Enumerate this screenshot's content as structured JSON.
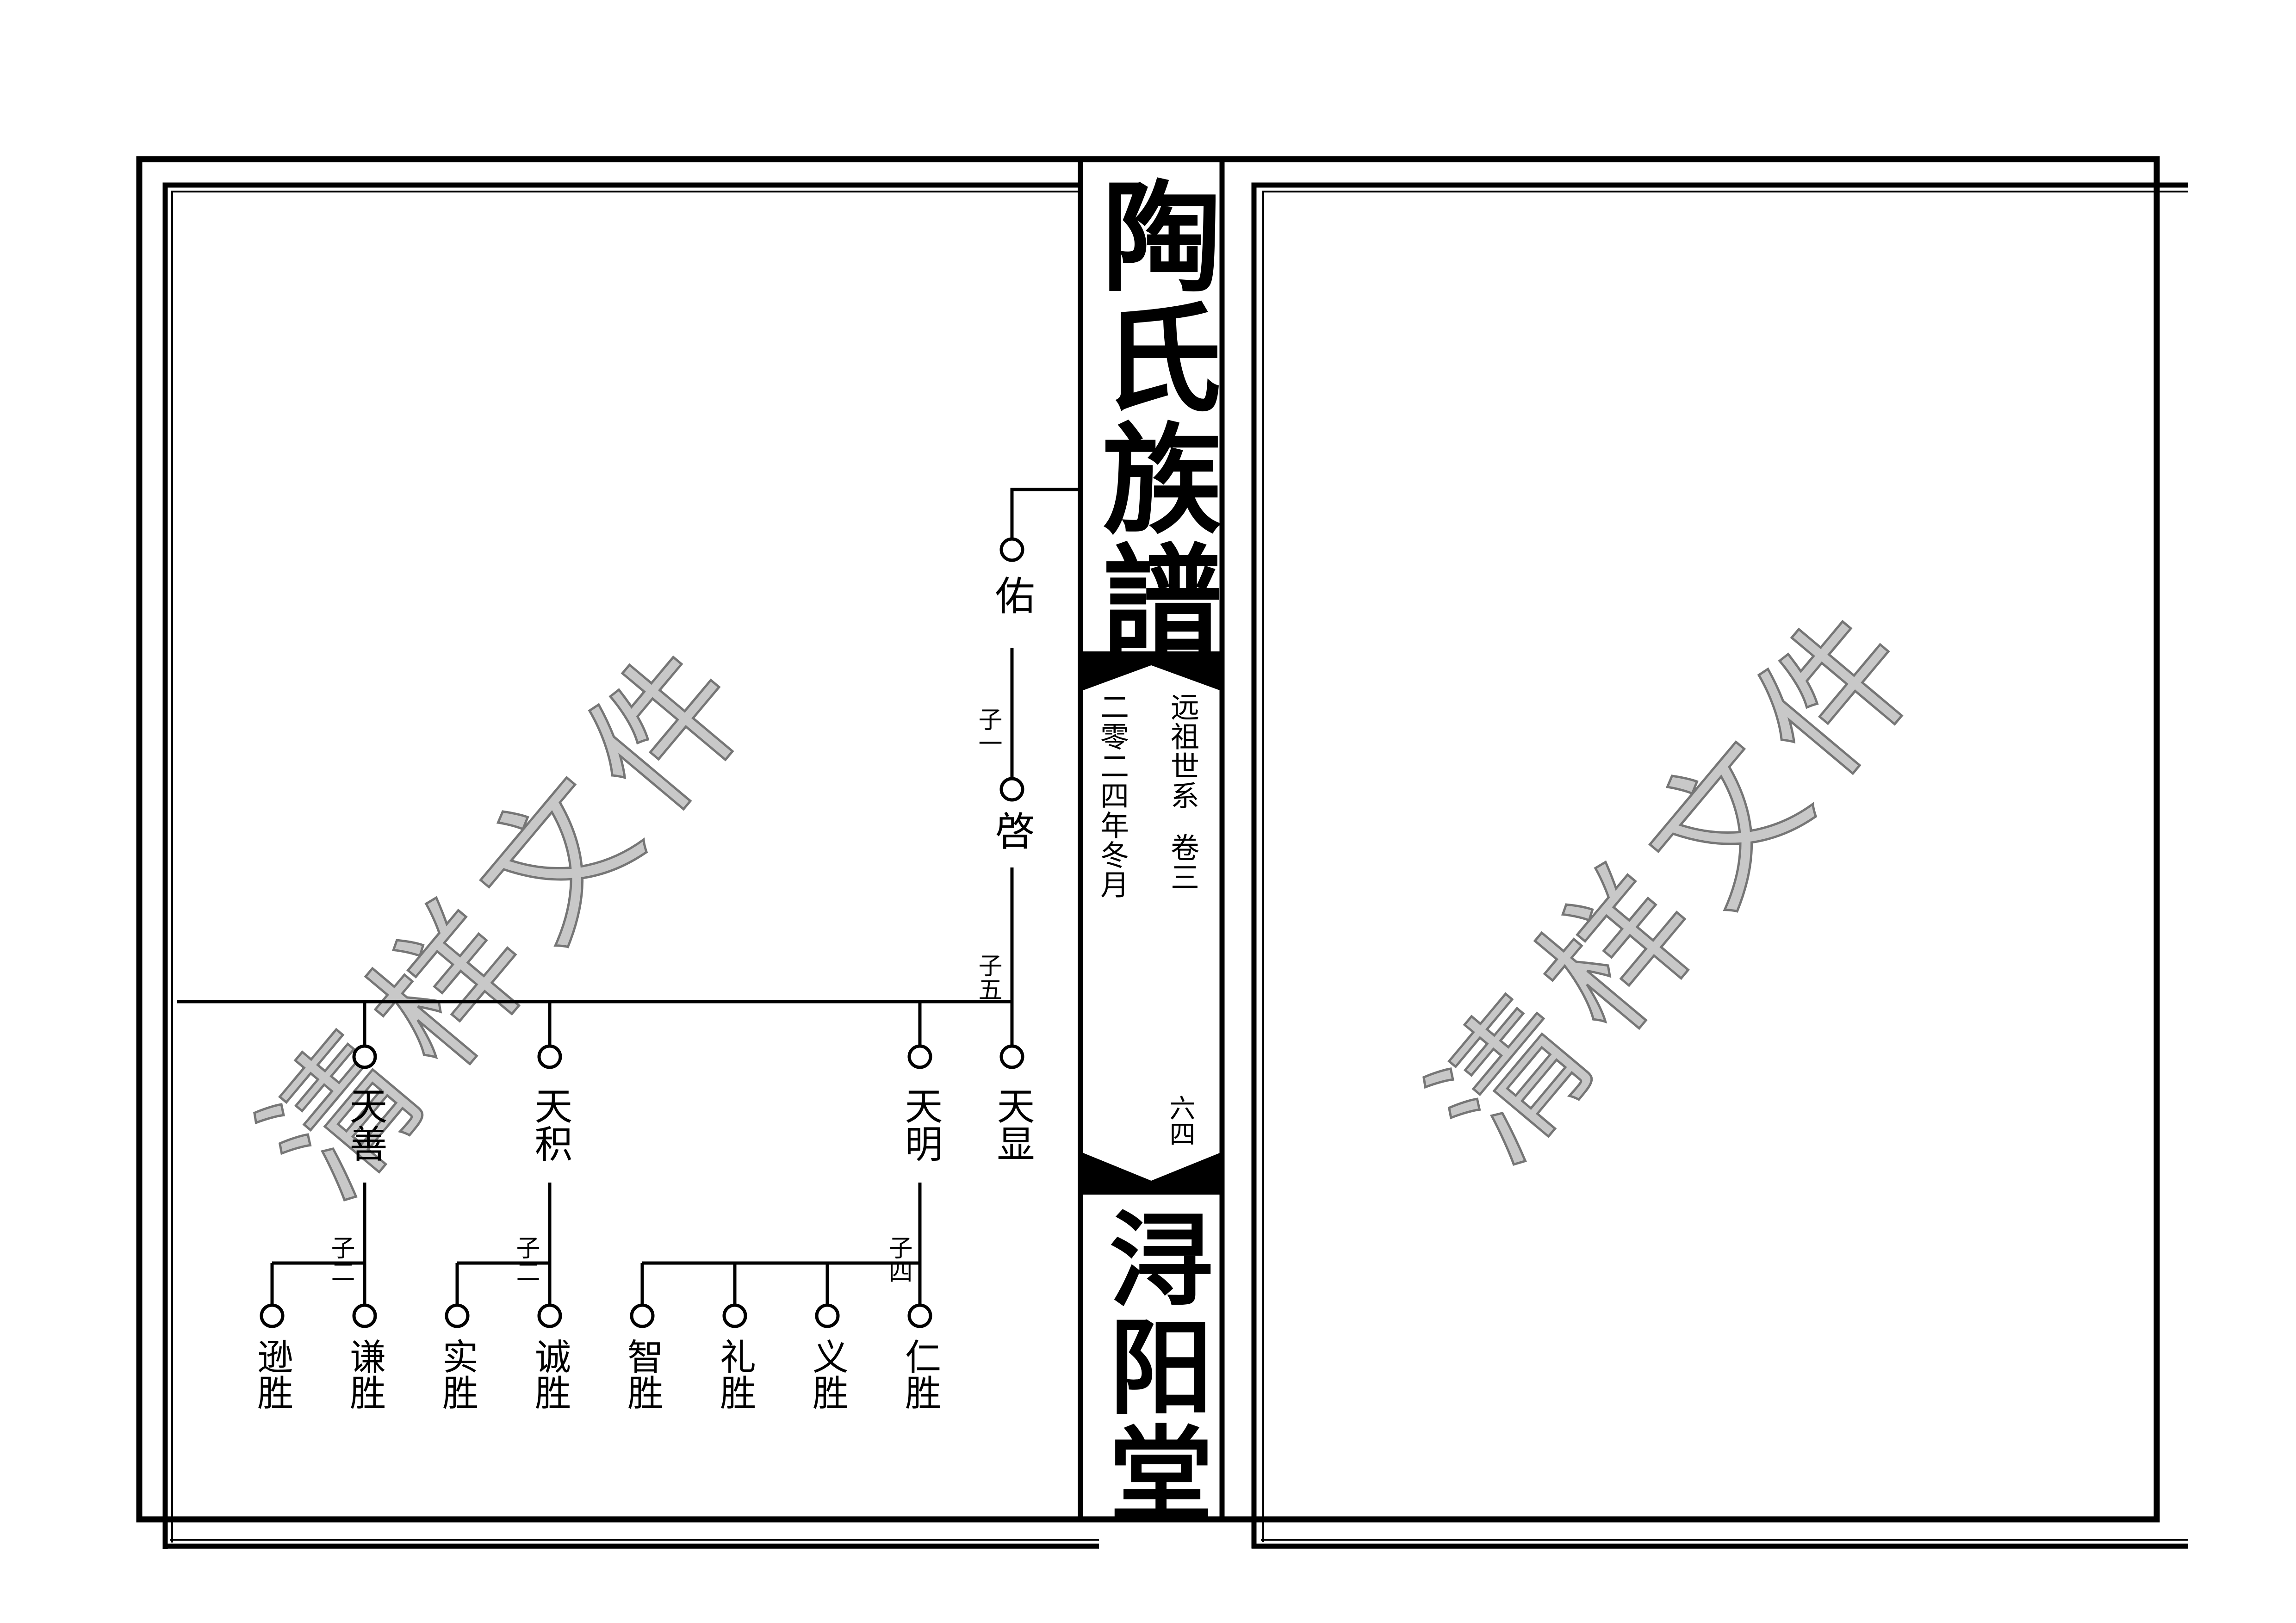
{
  "spine": {
    "title": "陶氏族譜",
    "section": "远祖世系",
    "volume": "卷三",
    "date": "二零二四年冬月",
    "page_number": "六四",
    "hall": "浔阳堂",
    "band_color": "#000000"
  },
  "watermark": {
    "text": "清样文件",
    "fill_color": "#c8c8c8",
    "outline_color": "#767676"
  },
  "tree": {
    "gen1_name": "佑",
    "gen1_child_label": "子一",
    "gen2_name": "啓",
    "gen2_child_label": "子五",
    "gen3_names": [
      "天善",
      "天积",
      "天明",
      "天显"
    ],
    "gen4_groups": [
      {
        "label": "子二",
        "children": [
          "逊胜",
          "谦胜"
        ]
      },
      {
        "label": "子二",
        "children": [
          "实胜",
          "诚胜"
        ]
      },
      {
        "label": "子四",
        "children": [
          "智胜",
          "礼胜",
          "义胜",
          "仁胜"
        ]
      }
    ]
  }
}
